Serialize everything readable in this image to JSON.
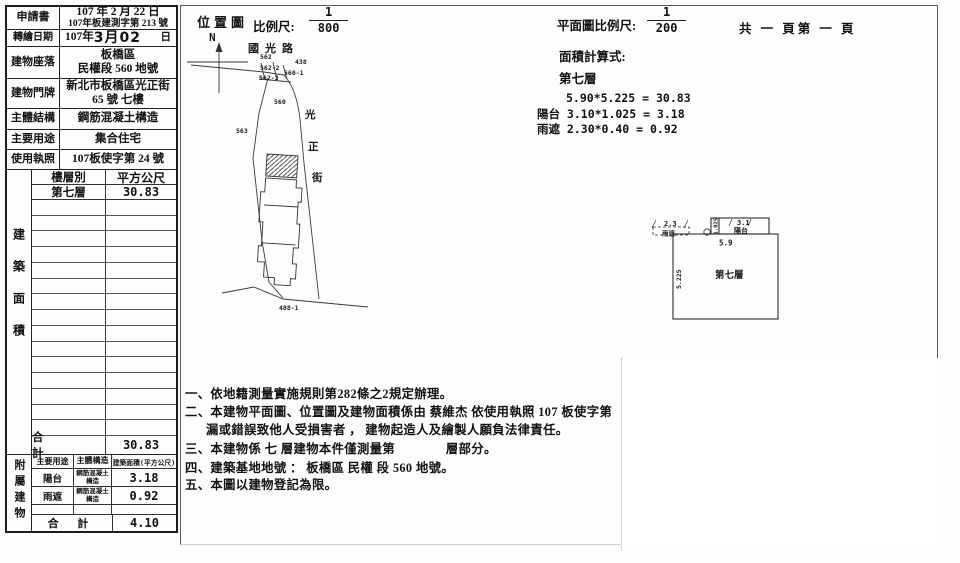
{
  "info_table": {
    "rows": [
      {
        "label": "申請書",
        "line1": "107 年 2 月 22 日",
        "line2": "107年板建測字第 213 號"
      },
      {
        "label": "轉繪日期",
        "pre": "107年",
        "stamp": "3月02",
        "suffix": "日"
      },
      {
        "label": "建物座落",
        "line1": "板橋區",
        "line2": "民權段 560 地號"
      },
      {
        "label": "建物門牌",
        "line1": "新北市板橋區光正街",
        "line2": "65 號 七樓"
      },
      {
        "label": "主體結構",
        "value": "鋼筋混凝土構造"
      },
      {
        "label": "主要用途",
        "value": "集合住宅"
      },
      {
        "label": "使用執照",
        "value": "107板使字第 24 號"
      }
    ]
  },
  "floor_table": {
    "side_label": "建築面積",
    "col1": "樓層別",
    "col2": "平方公尺",
    "row_floor": "第七層",
    "row_area": "30.83",
    "total_label": "合　計",
    "total_value": "30.83"
  },
  "annex_table": {
    "side_label": "附屬建物",
    "h1": "主要用途",
    "h2": "主體構造",
    "h3": "建築面積(平方公尺)",
    "rows": [
      {
        "use": "陽台",
        "structure": "鋼筋混凝土構造",
        "area": "3.18"
      },
      {
        "use": "雨遮",
        "structure": "鋼筋混凝土構造",
        "area": "0.92"
      }
    ],
    "total_label": "合 計",
    "total_value": "4.10"
  },
  "location_map": {
    "title": "位置圖",
    "scale_label": "比例尺:",
    "scale_numerator": "1",
    "scale_denominator": "800",
    "north": "N",
    "road_top": "國光路",
    "street_char1": "光",
    "street_char2": "正",
    "street_char3": "街",
    "parcels": {
      "p562": "562",
      "p438": "438",
      "p562_2": "562-2",
      "p560_1": "560-1",
      "p562_3": "562-3",
      "p560": "560",
      "p563": "563",
      "p488_1": "488-1"
    }
  },
  "plan": {
    "scale_label": "平面圖比例尺:",
    "scale_numerator": "1",
    "scale_denominator": "200",
    "page_label": "共 一 頁第 一 頁",
    "calc_title": "面積計算式:",
    "calc_floor": "第七層",
    "calc_lines": [
      "5.90*5.225 = 30.83",
      "陽台 3.10*1.025 = 3.18",
      "雨遮 2.30*0.40 = 0.92"
    ],
    "floorplan": {
      "main_label": "第七層",
      "dim_w": "5.9",
      "dim_h": "5.225",
      "balcony_label": "陽台",
      "balcony_dim": "3.1",
      "balcony_depth": "1.025",
      "canopy_label": "雨遮",
      "canopy_dim": "2.3"
    }
  },
  "notes": {
    "lines": [
      "一、依地籍測量實施規則第282條之2規定辦理。",
      "二、本建物平面圖、位置圖及建物面積係由 蔡維杰 依使用執照 107 板使字第",
      "漏或錯誤致他人受損害者 ， 建物起造人及繪製人願負法律責任。",
      "三、本建物係 七 層建物本件僅測量第　　　　層部分。",
      "四、建築基地地號 ： 板橋區 民權 段 560 地號。",
      "五、本圖以建物登記為限。"
    ]
  }
}
